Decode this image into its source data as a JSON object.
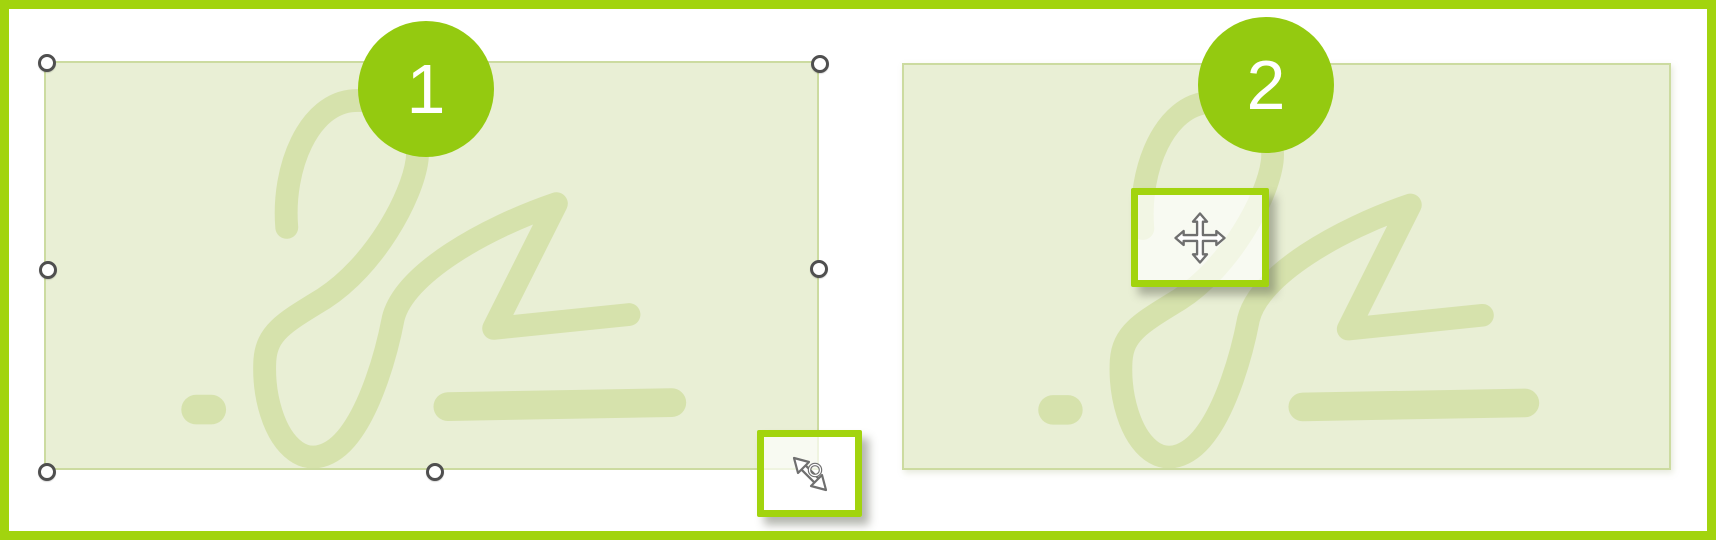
{
  "figure": {
    "description_text": "",
    "panels": [
      {
        "badge": "1",
        "cursor_icon": "diagonal-resize-cursor-icon",
        "selection_handles": [
          "top-left",
          "top-right",
          "middle-left",
          "middle-right",
          "bottom-left",
          "bottom-center"
        ]
      },
      {
        "badge": "2",
        "cursor_icon": "move-cursor-icon",
        "selection_handles": []
      }
    ],
    "icons": {
      "resize": "diagonal-resize-cursor-icon",
      "move": "move-cursor-icon",
      "watermark": "signature-scribble"
    },
    "colors": {
      "frame_border": "#a2d40e",
      "badge_fill": "#94ca10",
      "badge_text": "#ffffff",
      "callout_border": "#a2d40e",
      "pad_fill": "#e9efd5",
      "pad_border": "#ccdba0",
      "signature_stroke": "#c4d584",
      "handle_ring": "#4f4f4f",
      "cursor_outline": "#6f6f6f",
      "cursor_fill": "#ffffff"
    }
  }
}
